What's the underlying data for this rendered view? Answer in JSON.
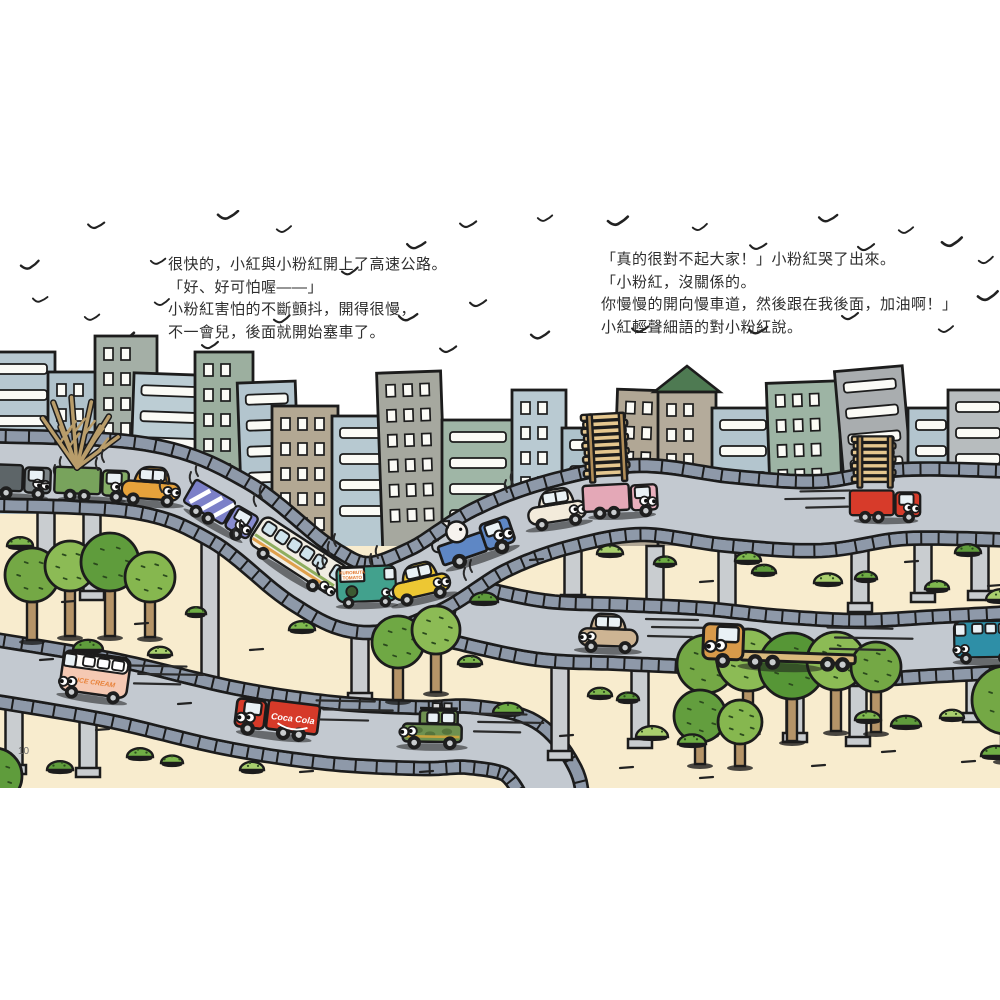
{
  "page": {
    "width": 1000,
    "height": 1000,
    "page_number": "10"
  },
  "story": {
    "left": {
      "lines": [
        "很快的，小紅與小粉紅開上了高速公路。",
        "「好、好可怕喔——」",
        "小粉紅害怕的不斷顫抖，開得很慢，",
        "不一會兒，後面就開始塞車了。"
      ]
    },
    "right": {
      "lines": [
        "「真的很對不起大家！」小粉紅哭了出來。",
        "「小粉紅，沒關係的。",
        "你慢慢的開向慢車道，然後跟在我後面，加油啊！」",
        "小紅輕聲細語的對小粉紅說。"
      ]
    }
  },
  "vehicle_labels": {
    "ice_cream": "ICE CREAM",
    "cola": "Coca Cola",
    "produce_top": "KUROBUTA",
    "produce_bottom": "TOMATO"
  },
  "palette": {
    "outline": "#1c1c1c",
    "sand": "#f8ecce",
    "road_surface": "#c3c9d0",
    "rail": "#8e99a9",
    "pillar": "#c9cdd0",
    "window": "#fbfbf6",
    "lumber": "#e5c78f",
    "pole": "#b08d58",
    "tree_trunk": "#b59468"
  },
  "scene": {
    "frame": {
      "top": 210,
      "bottom": 788
    },
    "birds": [
      [
        30,
        266
      ],
      [
        96,
        226
      ],
      [
        158,
        262
      ],
      [
        228,
        216
      ],
      [
        284,
        230
      ],
      [
        350,
        272
      ],
      [
        416,
        246
      ],
      [
        468,
        225
      ],
      [
        92,
        318
      ],
      [
        124,
        338
      ],
      [
        162,
        303
      ],
      [
        282,
        320
      ],
      [
        408,
        318
      ],
      [
        478,
        304
      ],
      [
        545,
        219
      ],
      [
        618,
        222
      ],
      [
        700,
        228
      ],
      [
        758,
        247
      ],
      [
        828,
        219
      ],
      [
        866,
        248
      ],
      [
        906,
        231
      ],
      [
        952,
        243
      ],
      [
        986,
        261
      ],
      [
        640,
        330
      ],
      [
        758,
        331
      ],
      [
        850,
        317
      ],
      [
        946,
        330
      ],
      [
        988,
        297
      ],
      [
        40,
        300
      ],
      [
        448,
        350
      ],
      [
        540,
        336
      ],
      [
        210,
        346
      ]
    ],
    "buildings": [
      {
        "x": -15,
        "w": 70,
        "t": 352,
        "b": 548,
        "c": "#b7c8d0",
        "s": "bands",
        "r": 0
      },
      {
        "x": 48,
        "w": 50,
        "t": 372,
        "b": 548,
        "c": "#b0c2cb",
        "s": "grid",
        "r": 0
      },
      {
        "x": 95,
        "w": 62,
        "t": 336,
        "b": 548,
        "c": "#a4afa6",
        "s": "grid",
        "r": 0
      },
      {
        "x": 128,
        "w": 72,
        "t": 374,
        "b": 548,
        "c": "#bccdd4",
        "s": "bands",
        "r": 2
      },
      {
        "x": 195,
        "w": 58,
        "t": 352,
        "b": 548,
        "c": "#9caf9f",
        "s": "grid",
        "r": 0
      },
      {
        "x": 243,
        "w": 58,
        "t": 382,
        "b": 548,
        "c": "#b3c5ce",
        "s": "bands",
        "r": -2
      },
      {
        "x": 272,
        "w": 66,
        "t": 406,
        "b": 550,
        "c": "#b3a893",
        "s": "grid",
        "r": 0
      },
      {
        "x": 332,
        "w": 82,
        "t": 416,
        "b": 552,
        "c": "#b7c9d1",
        "s": "bands",
        "r": 0
      },
      {
        "x": 383,
        "w": 64,
        "t": 372,
        "b": 556,
        "c": "#a6a89f",
        "s": "grid",
        "r": -2
      },
      {
        "x": 442,
        "w": 72,
        "t": 420,
        "b": 548,
        "c": "#9fb6a6",
        "s": "bands",
        "r": 0
      },
      {
        "x": 512,
        "w": 54,
        "t": 390,
        "b": 548,
        "c": "#b9cad2",
        "s": "grid",
        "r": 0
      },
      {
        "x": 562,
        "w": 50,
        "t": 428,
        "b": 548,
        "c": "#aec2cb",
        "s": "bands",
        "r": 0
      },
      {
        "x": 612,
        "w": 52,
        "t": 390,
        "b": 548,
        "c": "#b1a795",
        "s": "grid",
        "r": 2
      },
      {
        "x": 658,
        "w": 58,
        "t": 392,
        "b": 548,
        "c": "#b4ab9b",
        "s": "grid",
        "r": 0,
        "roof": "#4e7a52"
      },
      {
        "x": 712,
        "w": 62,
        "t": 408,
        "b": 548,
        "c": "#b3c5ce",
        "s": "bands",
        "r": 0
      },
      {
        "x": 772,
        "w": 72,
        "t": 382,
        "b": 548,
        "c": "#9db4a4",
        "s": "grid",
        "r": -2
      },
      {
        "x": 850,
        "w": 68,
        "t": 368,
        "b": 548,
        "c": "#a9adaf",
        "s": "bands",
        "r": -5
      },
      {
        "x": 908,
        "w": 46,
        "t": 408,
        "b": 548,
        "c": "#b3c5ce",
        "s": "bands",
        "r": 0
      },
      {
        "x": 948,
        "w": 60,
        "t": 390,
        "b": 548,
        "c": "#b7bcbe",
        "s": "bands",
        "r": 0
      }
    ],
    "roads": [
      {
        "name": "lower-road",
        "w": 48,
        "pts": [
          [
            -20,
            668
          ],
          [
            110,
            690
          ],
          [
            230,
            718
          ],
          [
            330,
            733
          ],
          [
            420,
            738
          ],
          [
            470,
            737
          ],
          [
            520,
            748
          ],
          [
            548,
            782
          ],
          [
            552,
            810
          ]
        ]
      },
      {
        "name": "middle-road",
        "w": 46,
        "pts": [
          [
            455,
            612
          ],
          [
            540,
            630
          ],
          [
            620,
            634
          ],
          [
            700,
            638
          ],
          [
            780,
            646
          ],
          [
            860,
            650
          ],
          [
            940,
            646
          ],
          [
            1015,
            642
          ]
        ]
      },
      {
        "name": "highway",
        "w": 56,
        "pts": [
          [
            -20,
            470
          ],
          [
            140,
            478
          ],
          [
            230,
            512
          ],
          [
            310,
            574
          ],
          [
            365,
            598
          ],
          [
            425,
            580
          ],
          [
            490,
            540
          ],
          [
            560,
            514
          ],
          [
            640,
            500
          ],
          [
            730,
            511
          ],
          [
            820,
            516
          ],
          [
            905,
            504
          ],
          [
            1020,
            506
          ]
        ]
      }
    ],
    "pillars_back": [
      [
        46,
        505,
        580
      ],
      [
        92,
        505,
        598
      ],
      [
        210,
        520,
        698
      ],
      [
        360,
        628,
        700
      ],
      [
        14,
        688,
        772
      ],
      [
        88,
        698,
        775
      ]
    ],
    "pillars_front": [
      [
        573,
        546,
        602
      ],
      [
        655,
        546,
        608
      ],
      [
        727,
        548,
        615
      ],
      [
        860,
        546,
        610
      ],
      [
        923,
        544,
        600
      ],
      [
        980,
        542,
        598
      ],
      [
        560,
        662,
        758
      ],
      [
        640,
        664,
        746
      ],
      [
        795,
        670,
        740
      ],
      [
        858,
        674,
        744
      ],
      [
        975,
        668,
        720
      ]
    ],
    "trees": [
      {
        "x": 32,
        "y": 575,
        "r": 27,
        "c": "#74a845",
        "h": 65
      },
      {
        "x": 70,
        "y": 566,
        "r": 25,
        "c": "#8cbb55",
        "h": 70
      },
      {
        "x": 110,
        "y": 562,
        "r": 29,
        "c": "#5f9c3c",
        "h": 74
      },
      {
        "x": 150,
        "y": 577,
        "r": 25,
        "c": "#86b74f",
        "h": 60
      },
      {
        "x": 398,
        "y": 642,
        "r": 26,
        "c": "#6fa844",
        "h": 58
      },
      {
        "x": 436,
        "y": 630,
        "r": 24,
        "c": "#8cbb55",
        "h": 62
      },
      {
        "x": 706,
        "y": 664,
        "r": 29,
        "c": "#74a845",
        "h": 70
      },
      {
        "x": 748,
        "y": 660,
        "r": 31,
        "c": "#8cbb55",
        "h": 72
      },
      {
        "x": 792,
        "y": 666,
        "r": 33,
        "c": "#569636",
        "h": 75
      },
      {
        "x": 836,
        "y": 661,
        "r": 29,
        "c": "#8cbb55",
        "h": 70
      },
      {
        "x": 876,
        "y": 667,
        "r": 25,
        "c": "#74a845",
        "h": 65
      },
      {
        "x": 700,
        "y": 716,
        "r": 26,
        "c": "#639e3e",
        "h": 48
      },
      {
        "x": 740,
        "y": 722,
        "r": 22,
        "c": "#86b74f",
        "h": 44
      },
      {
        "x": 1006,
        "y": 700,
        "r": 34,
        "c": "#74a845",
        "h": 60
      },
      {
        "x": -6,
        "y": 776,
        "r": 28,
        "c": "#5f9c3c",
        "h": 0
      }
    ],
    "bushes": [
      [
        20,
        546,
        13
      ],
      [
        88,
        650,
        15
      ],
      [
        160,
        655,
        12
      ],
      [
        196,
        614,
        10
      ],
      [
        302,
        630,
        13
      ],
      [
        484,
        602,
        14
      ],
      [
        610,
        554,
        13
      ],
      [
        665,
        564,
        11
      ],
      [
        748,
        561,
        13
      ],
      [
        764,
        573,
        12
      ],
      [
        828,
        583,
        14
      ],
      [
        866,
        579,
        11
      ],
      [
        937,
        589,
        12
      ],
      [
        968,
        553,
        13
      ],
      [
        1002,
        600,
        16
      ],
      [
        508,
        713,
        15
      ],
      [
        600,
        696,
        12
      ],
      [
        628,
        700,
        11
      ],
      [
        652,
        737,
        16
      ],
      [
        692,
        744,
        14
      ],
      [
        868,
        720,
        13
      ],
      [
        906,
        726,
        15
      ],
      [
        952,
        718,
        12
      ],
      [
        140,
        757,
        13
      ],
      [
        172,
        763,
        11
      ],
      [
        60,
        770,
        13
      ],
      [
        252,
        770,
        12
      ],
      [
        996,
        756,
        15
      ],
      [
        470,
        664,
        12
      ]
    ],
    "dashes": [
      [
        62,
        602
      ],
      [
        135,
        624
      ],
      [
        250,
        650
      ],
      [
        178,
        704
      ],
      [
        96,
        730
      ],
      [
        300,
        772
      ],
      [
        530,
        560
      ],
      [
        700,
        582
      ],
      [
        905,
        562
      ],
      [
        988,
        586
      ],
      [
        620,
        768
      ],
      [
        700,
        778
      ],
      [
        812,
        766
      ],
      [
        882,
        752
      ],
      [
        962,
        762
      ],
      [
        560,
        736
      ],
      [
        420,
        772
      ],
      [
        40,
        660
      ]
    ],
    "vehicles": [
      {
        "name": "dark-truck",
        "type": "truck",
        "x": 14,
        "y": 495,
        "rot": 2,
        "dir": 1,
        "s": 1,
        "cab": "#7b8386",
        "box": "#5d6568",
        "eyes": "lid",
        "vib": 1
      },
      {
        "name": "tree-truck",
        "type": "truck",
        "x": 92,
        "y": 498,
        "rot": 2,
        "dir": 1,
        "s": 1,
        "cab": "#85ad66",
        "box": "#78a35c",
        "cargo": "tree"
      },
      {
        "name": "orange-car",
        "type": "car",
        "x": 150,
        "y": 502,
        "rot": 4,
        "dir": 1,
        "s": 1,
        "color": "#e6a23b",
        "vib": 1
      },
      {
        "name": "striped-truck",
        "type": "truck",
        "x": 214,
        "y": 524,
        "rot": 30,
        "dir": 1,
        "s": 1,
        "cab": "#888cd0",
        "box": "#7c80c8",
        "cargo": "stripes",
        "vib": 1
      },
      {
        "name": "bus",
        "type": "bus",
        "x": 288,
        "y": 572,
        "rot": 33,
        "dir": 1,
        "s": 1,
        "color": "#f1ede2",
        "vib": 1
      },
      {
        "name": "produce-van",
        "type": "van",
        "x": 367,
        "y": 604,
        "rot": -2,
        "dir": 1,
        "s": 0.92,
        "color": "#42a18d",
        "sign": 1,
        "vib": 1
      },
      {
        "name": "yellow-car",
        "type": "car",
        "x": 424,
        "y": 598,
        "rot": -13,
        "dir": 1,
        "s": 1,
        "color": "#edc733",
        "vib": 1
      },
      {
        "name": "pig-pickup",
        "type": "pickup",
        "x": 482,
        "y": 556,
        "rot": -19,
        "dir": 1,
        "s": 1.15,
        "color": "#5e87c5"
      },
      {
        "name": "cream-car",
        "type": "car",
        "x": 559,
        "y": 524,
        "rot": -9,
        "dir": 1,
        "s": 1,
        "color": "#f3ebdb",
        "vib": 1
      },
      {
        "name": "pink-lumber-truck",
        "type": "truck",
        "x": 622,
        "y": 514,
        "rot": -3,
        "dir": 1,
        "s": 1,
        "cab": "#e9b0bd",
        "box": "#e4a8b7",
        "cargo": "lumber",
        "lh": 9
      },
      {
        "name": "red-lumber-truck",
        "type": "truck",
        "x": 886,
        "y": 519,
        "rot": 0,
        "dir": 1,
        "s": 0.95,
        "cab": "#d73b2a",
        "box": "#d73b2a",
        "cargo": "lumber",
        "lh": 7,
        "speed": 1
      },
      {
        "name": "tan-car",
        "type": "car",
        "x": 608,
        "y": 649,
        "rot": 2,
        "dir": -1,
        "s": 1,
        "color": "#cdb493",
        "speed": 1
      },
      {
        "name": "flatbed-truck",
        "type": "flatbed",
        "x": 780,
        "y": 665,
        "rot": 2,
        "dir": -1,
        "s": 1.25,
        "cab": "#d89a4a",
        "bed": "#d9ba7d",
        "speed": 1
      },
      {
        "name": "teal-van",
        "type": "van",
        "x": 985,
        "y": 660,
        "rot": -1,
        "dir": -1,
        "s": 0.95,
        "color": "#2e8fa7"
      },
      {
        "name": "ice-cream-van",
        "type": "van",
        "x": 92,
        "y": 697,
        "rot": 8,
        "dir": -1,
        "s": 1.05,
        "color": "#f5c9b3",
        "ice": 1,
        "speed": 1
      },
      {
        "name": "cola-truck",
        "type": "truck",
        "x": 274,
        "y": 734,
        "rot": 7,
        "dir": -1,
        "s": 1.12,
        "cab": "#d63a29",
        "box": "#d63a29",
        "cola": 1,
        "speed": 1
      },
      {
        "name": "green-jeep",
        "type": "jeep",
        "x": 432,
        "y": 745,
        "rot": 1,
        "dir": -1,
        "s": 1.05,
        "color": "#6e9150",
        "speed": 1
      }
    ]
  }
}
